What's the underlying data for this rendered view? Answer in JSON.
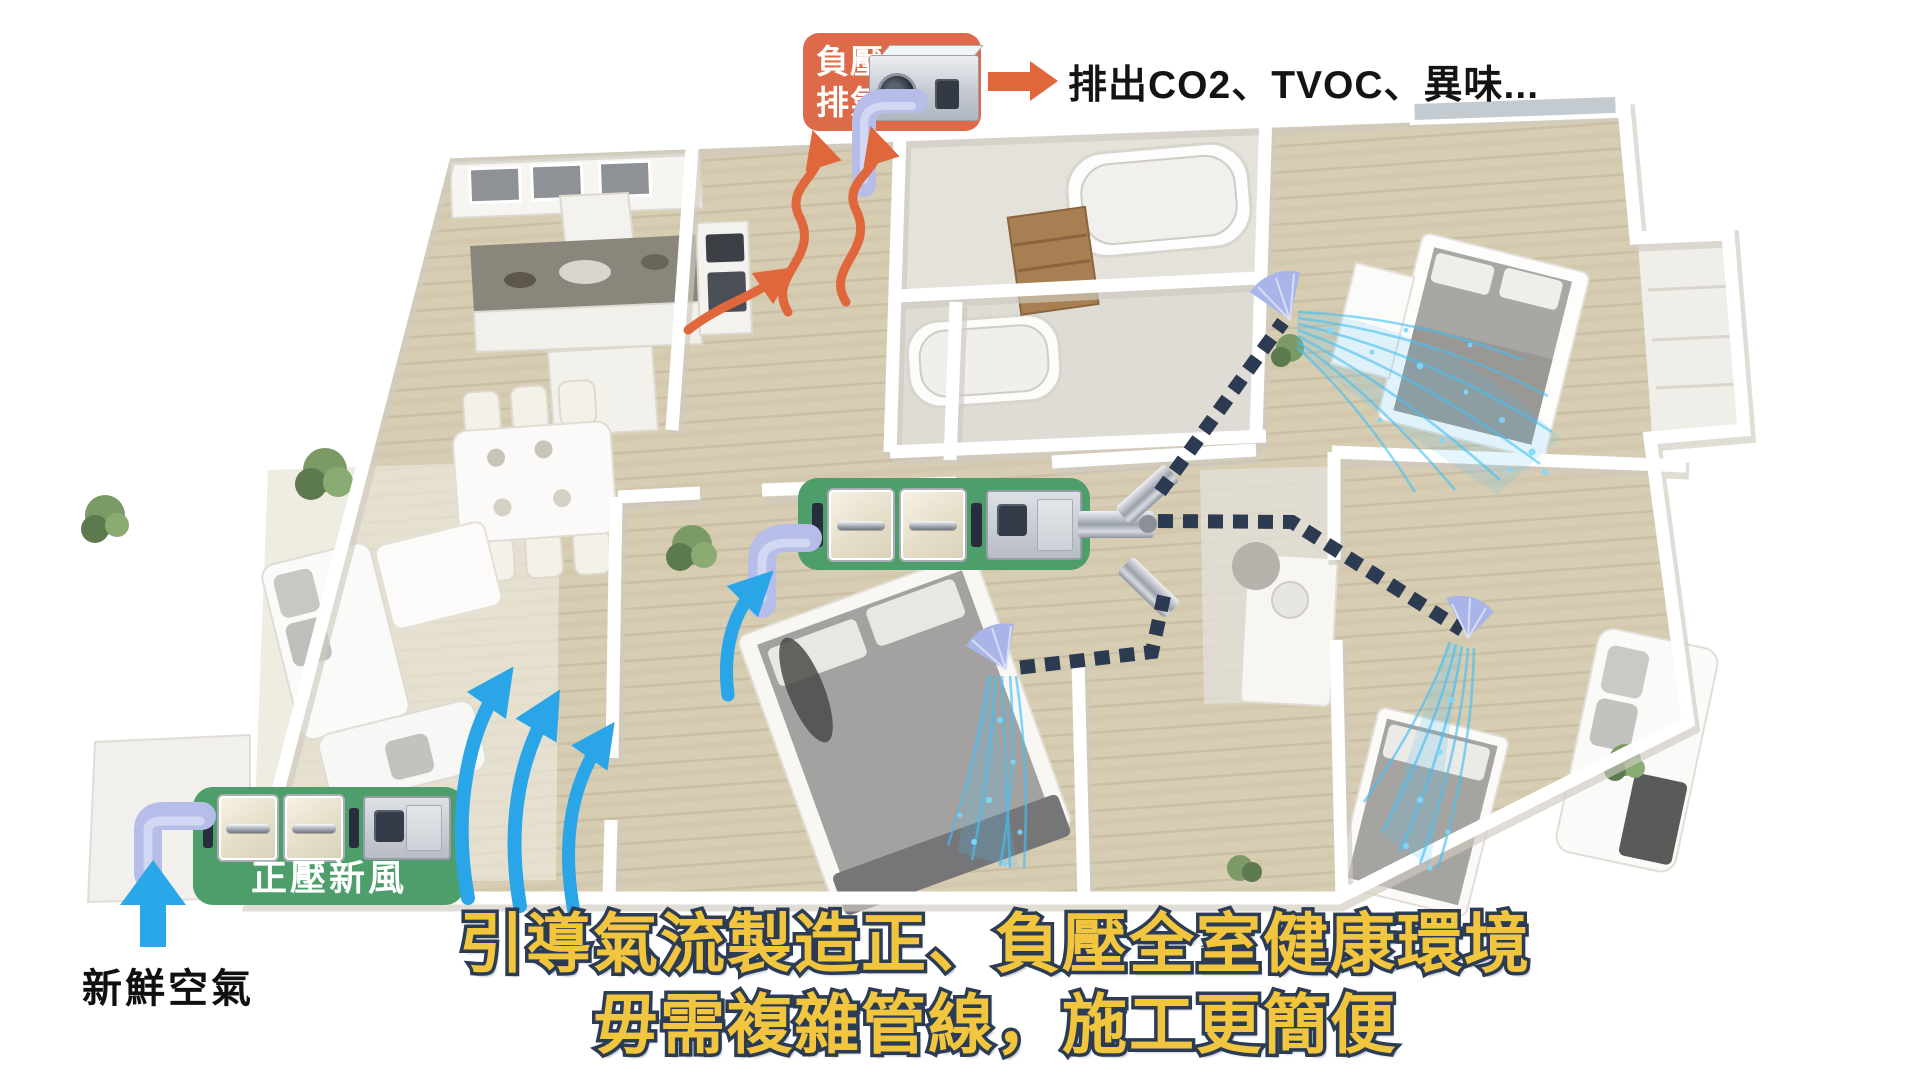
{
  "headline": {
    "line1": "引導氣流製造正、負壓全室健康環境",
    "line2": "毋需複雜管線，施工更簡便"
  },
  "exhaust": {
    "label_line1": "負壓",
    "label_line2": "排氣",
    "output_text": "排出CO2、TVOC、異味..."
  },
  "supply": {
    "label": "正壓新風",
    "fresh_air_label": "新鮮空氣"
  },
  "colors": {
    "exhaust_orange": "#DD6A49",
    "arrow_orange": "#E0663C",
    "supply_green": "#4D9E6A",
    "airflow_blue": "#29A5E8",
    "spray_blue": "#45C0F5",
    "duct_navy": "#2C3A52",
    "duct_purple": "#B6BDE9",
    "headline_yellow": "#F1C63E",
    "headline_outline": "#2C3C55"
  }
}
